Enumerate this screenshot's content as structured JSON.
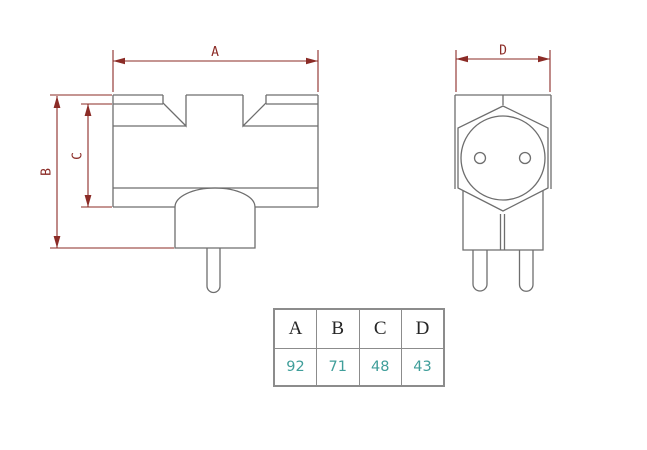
{
  "drawing": {
    "dimension_labels": {
      "a": "A",
      "b": "B",
      "c": "C",
      "d": "D"
    }
  },
  "table": {
    "headers": [
      "A",
      "B",
      "C",
      "D"
    ],
    "values": [
      "92",
      "71",
      "48",
      "43"
    ]
  },
  "colors": {
    "dimension_line": "#8b2b26",
    "drawing_line": "#6e6e6e",
    "table_border": "#8c8c8c",
    "table_header_text": "#262626",
    "table_value_text": "#3f9e9a",
    "background": "#ffffff"
  }
}
